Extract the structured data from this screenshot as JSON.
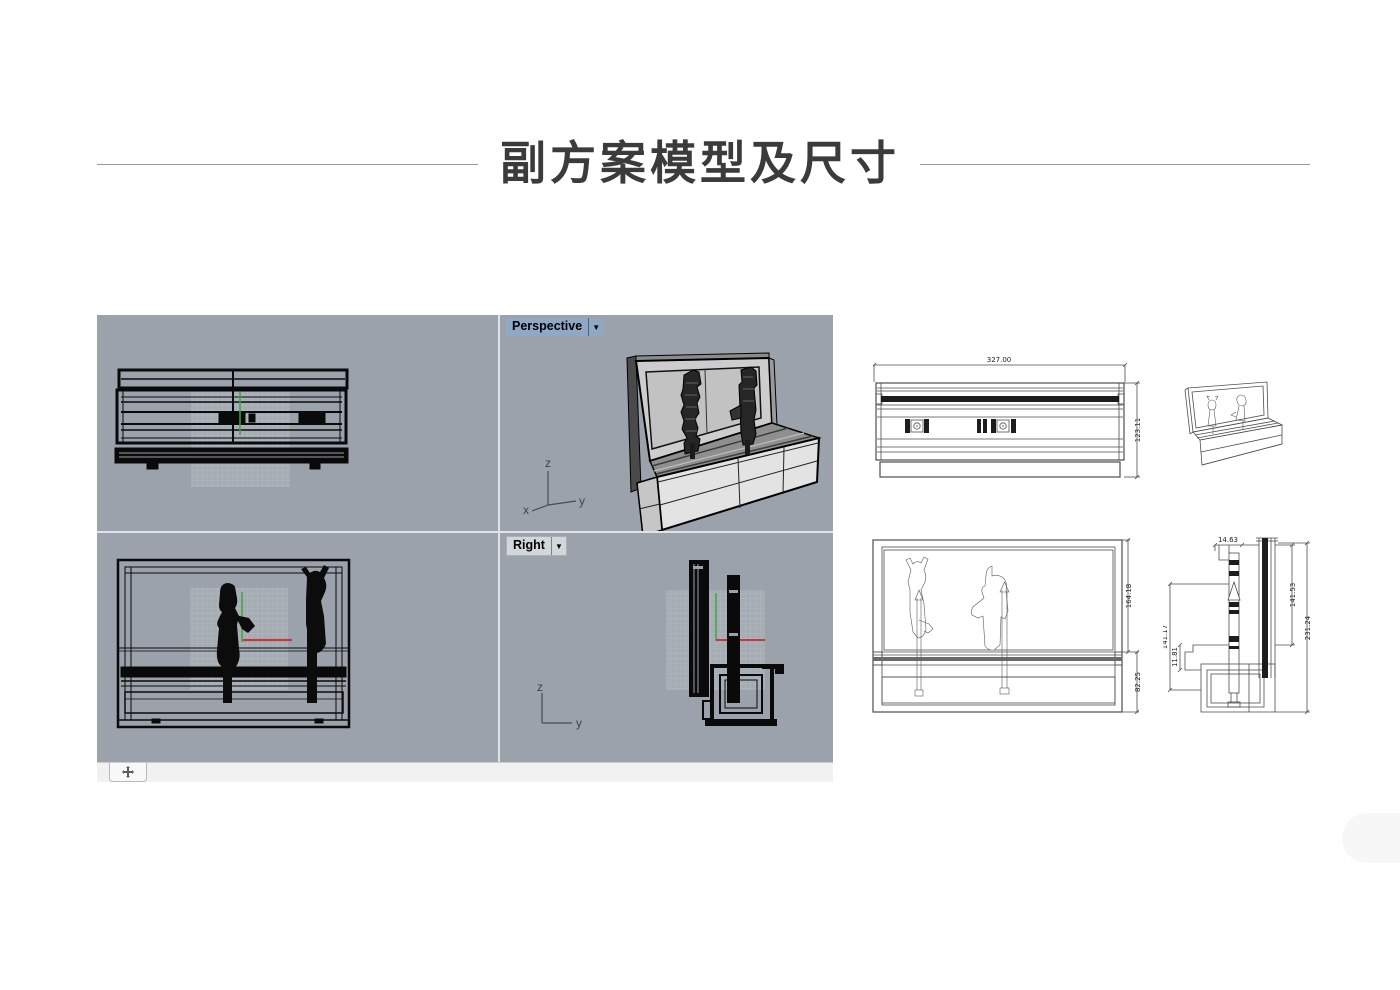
{
  "page": {
    "title": "副方案模型及尺寸"
  },
  "rhino": {
    "labels": {
      "perspective": "Perspective",
      "right": "Right"
    },
    "axes": {
      "x": "x",
      "y": "y",
      "z": "z"
    },
    "colors": {
      "viewport_bg": "#9ba2ab",
      "active_label_bg": "#8ea8c6",
      "inactive_label_bg": "#d3d7db",
      "axis_green": "#3fa344",
      "axis_red": "#c23b3b"
    }
  },
  "dims": {
    "top_view": {
      "width": "327.00",
      "depth": "123.11"
    },
    "front_view": {
      "upper": "164.18",
      "lower": "82.25"
    },
    "side_view": {
      "top": "14.63",
      "panel": "141.53",
      "total": "231.24",
      "left": "141.17",
      "step": "11.81"
    }
  }
}
